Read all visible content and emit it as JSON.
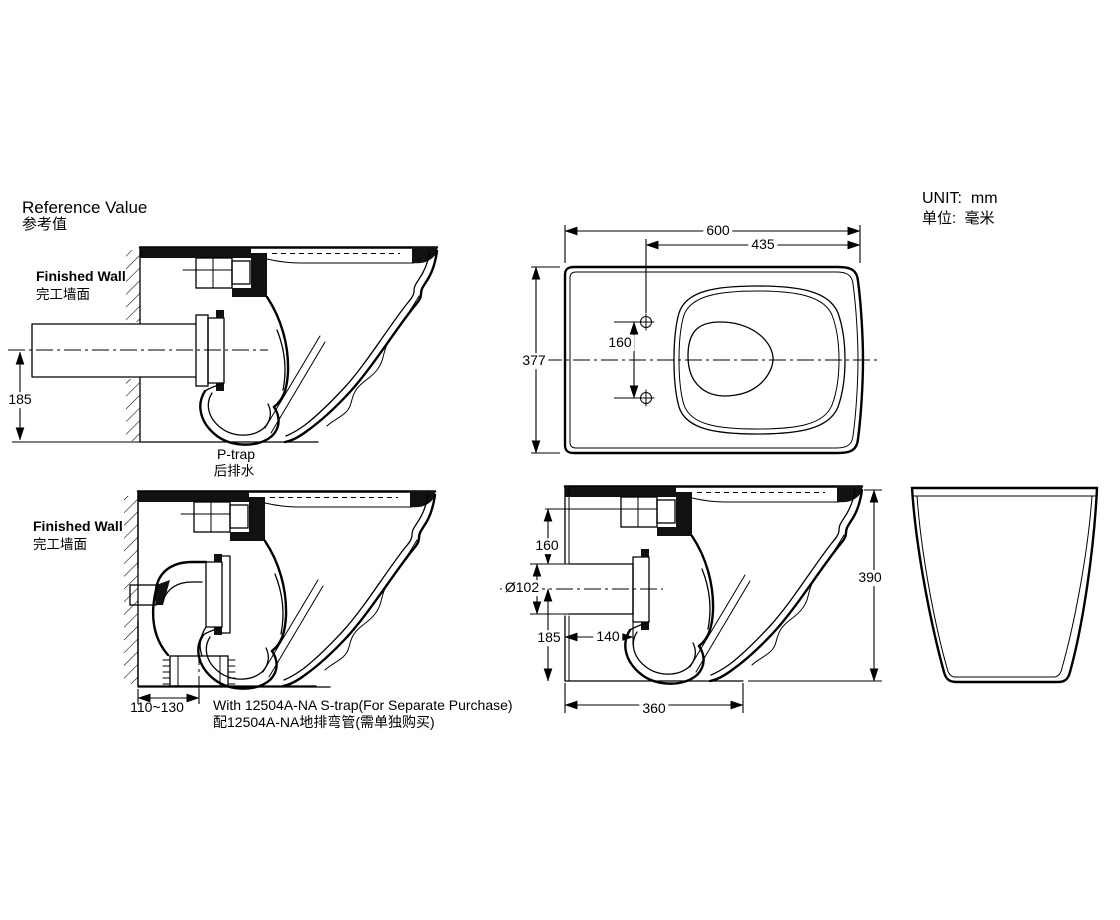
{
  "page": {
    "title_en": "Reference Value",
    "title_zh": "参考值",
    "unit_en": "UNIT:  mm",
    "unit_zh": "单位:  毫米"
  },
  "colors": {
    "ink": "#000000",
    "background": "#ffffff"
  },
  "p_trap_view": {
    "finished_wall_en": "Finished Wall",
    "finished_wall_zh": "完工墙面",
    "caption_en": "P-trap",
    "caption_zh": "后排水",
    "dim_outlet_center_height": "185"
  },
  "plan_view": {
    "dim_overall_length": "600",
    "dim_holes_to_front": "435",
    "dim_overall_width": "377",
    "dim_hole_spacing": "160"
  },
  "s_trap_view": {
    "finished_wall_en": "Finished Wall",
    "finished_wall_zh": "完工墙面",
    "dim_outlet_offset": "110~130",
    "caption_en": "With 12504A-NA S-trap(For Separate Purchase)",
    "caption_zh": "配12504A-NA地排弯管(需单独购买)"
  },
  "side_view": {
    "dim_top_to_outlet": "160",
    "dim_outlet_diameter": "Ø102",
    "dim_center_to_bottom": "185",
    "dim_wall_to_outlet_end": "140",
    "dim_body_bottom_length": "360",
    "dim_overall_height": "390"
  }
}
